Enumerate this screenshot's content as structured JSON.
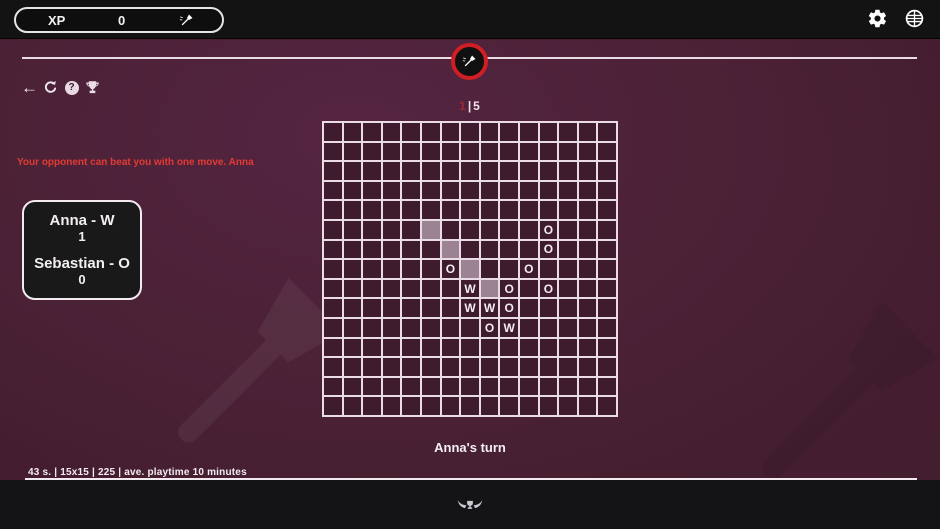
{
  "top_bar": {
    "xp_label": "XP",
    "xp_value": "0"
  },
  "toolbar": {
    "back_glyph": "←",
    "help_glyph": "?"
  },
  "round_indicator": {
    "current": "1",
    "separator": "|",
    "total": "5"
  },
  "warning_text": "Your opponent can beat you with one move. Anna",
  "scoreboard": {
    "players": [
      {
        "name": "Anna - W",
        "score": "1"
      },
      {
        "name": "Sebastian - O",
        "score": "0"
      }
    ]
  },
  "board": {
    "rows": 15,
    "cols": 15,
    "pieces": [
      {
        "r": 5,
        "c": 11,
        "t": "O"
      },
      {
        "r": 6,
        "c": 11,
        "t": "O"
      },
      {
        "r": 7,
        "c": 6,
        "t": "O"
      },
      {
        "r": 7,
        "c": 10,
        "t": "O"
      },
      {
        "r": 8,
        "c": 7,
        "t": "W"
      },
      {
        "r": 8,
        "c": 9,
        "t": "O"
      },
      {
        "r": 8,
        "c": 11,
        "t": "O"
      },
      {
        "r": 9,
        "c": 7,
        "t": "W"
      },
      {
        "r": 9,
        "c": 8,
        "t": "W"
      },
      {
        "r": 9,
        "c": 9,
        "t": "O"
      },
      {
        "r": 10,
        "c": 8,
        "t": "O"
      },
      {
        "r": 10,
        "c": 9,
        "t": "W"
      }
    ],
    "highlighted_cells": [
      {
        "r": 5,
        "c": 5
      },
      {
        "r": 6,
        "c": 6
      },
      {
        "r": 7,
        "c": 7
      },
      {
        "r": 8,
        "c": 8
      }
    ]
  },
  "turn_text": "Anna's turn",
  "status_bar": {
    "items": [
      "43 s.",
      "15x15",
      "225",
      "ave. playtime 10 minutes"
    ],
    "separator": "|"
  },
  "colors": {
    "accent_red": "#d01e25",
    "warning_red": "#e23b33",
    "board_line": "#e9dce5",
    "highlight_cell": "#9c8393"
  }
}
